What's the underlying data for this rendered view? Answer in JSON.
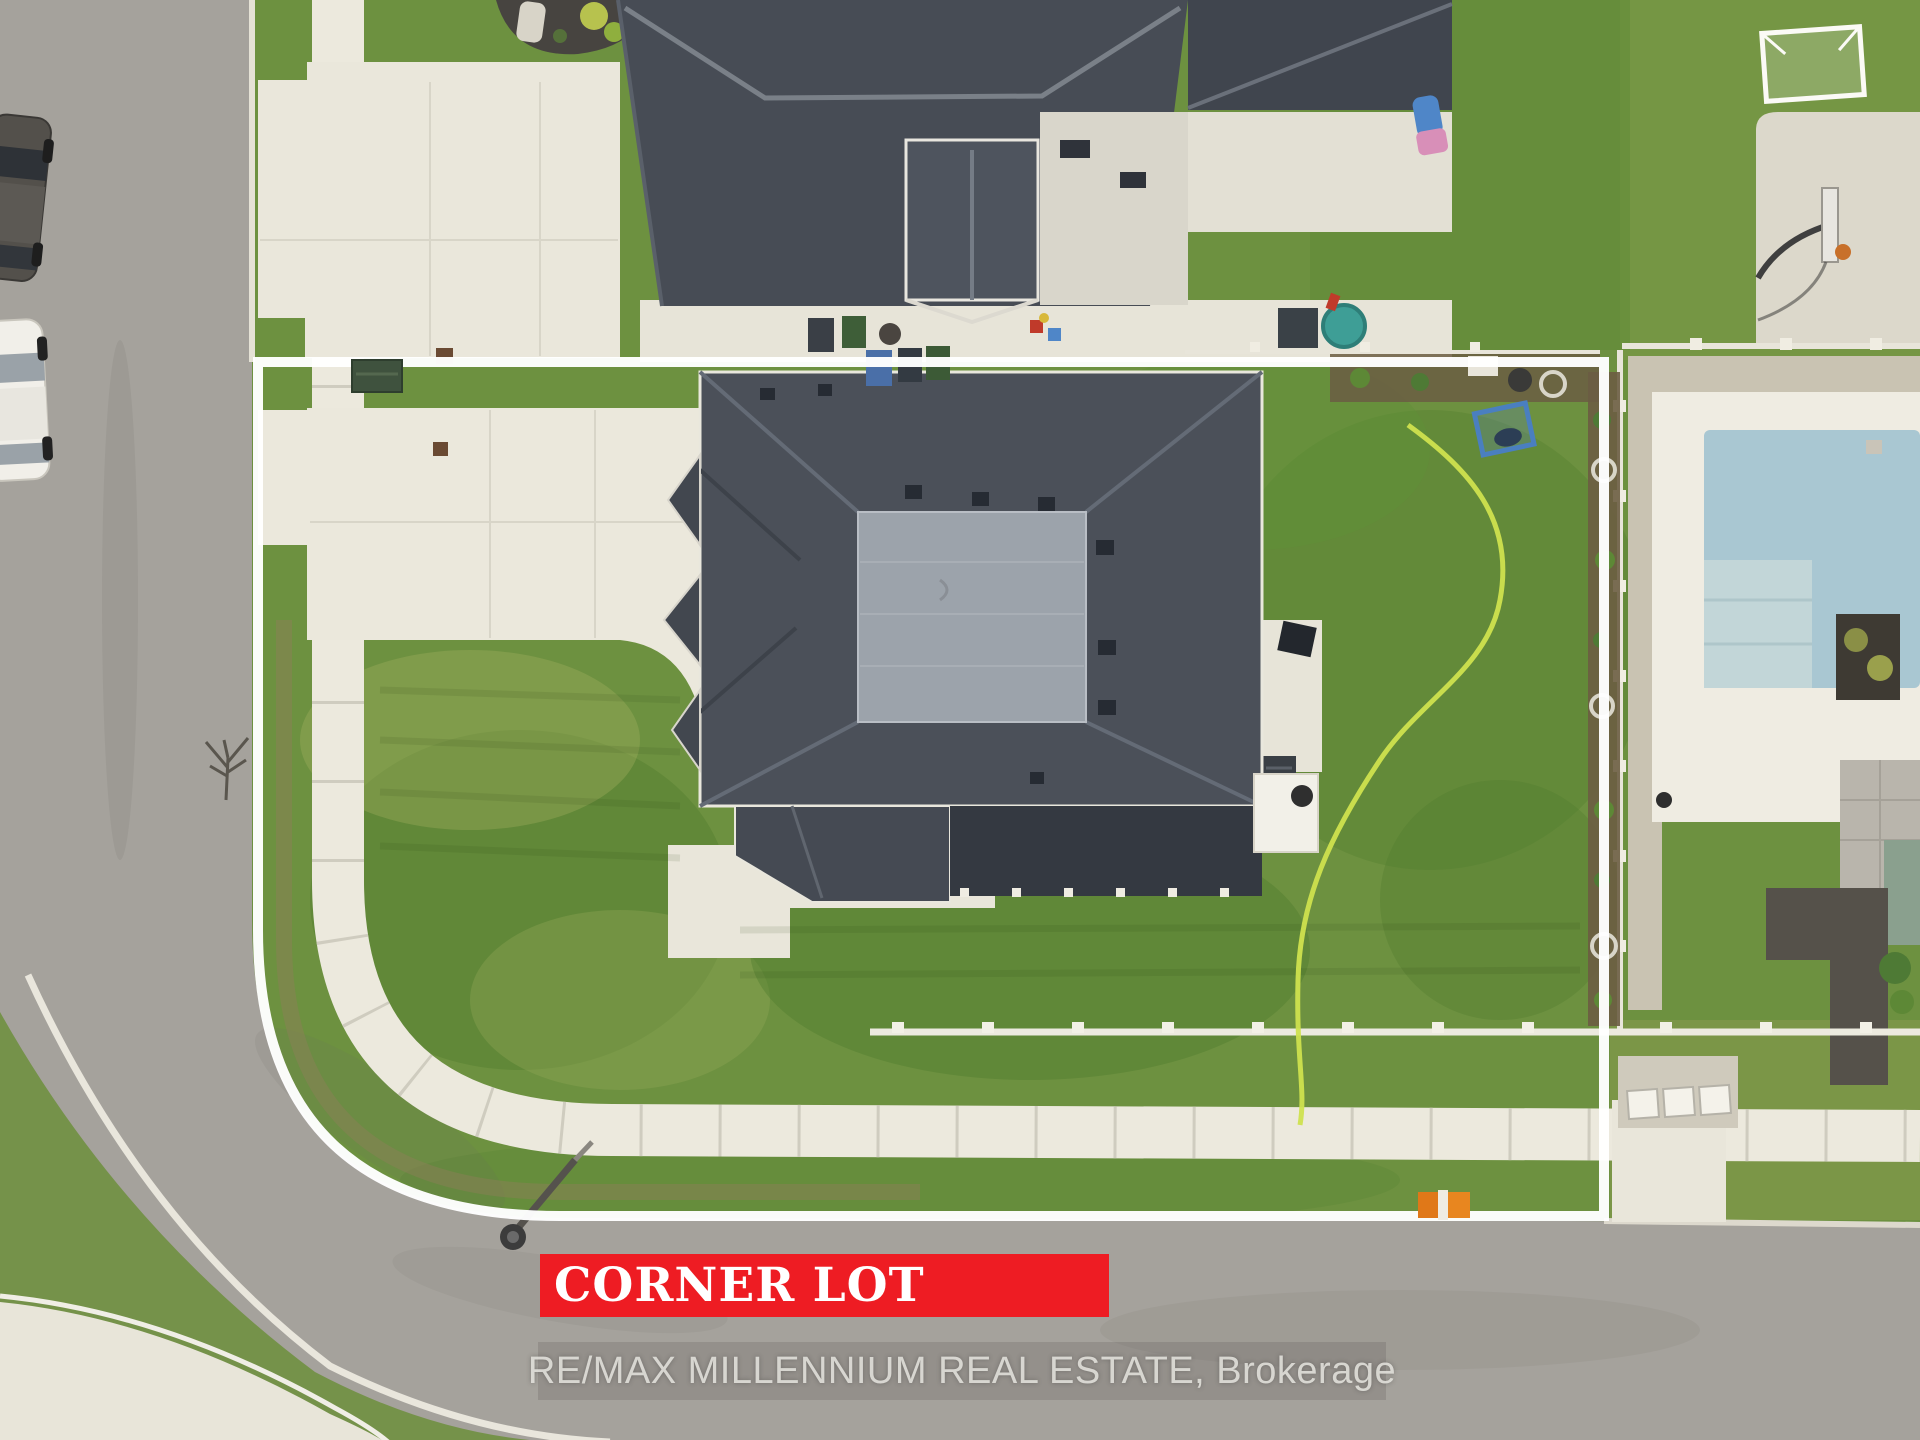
{
  "photo": {
    "type": "aerial-drone-top-down",
    "subject": "residential corner lot with detached house outlined in white",
    "visible_objects": [
      "subject house with dark shingle hip roof and flat roof section",
      "large concrete driveway and curved public sidewalk",
      "front lawn and fenced backyard with garden hose",
      "white property boundary overlay along two street frontages",
      "curved asphalt street corner",
      "two parked cars on left street",
      "street light and orange fire hydrant",
      "neighbour house at top with gable dormer, patio and bins",
      "neighbour yard at right with soccer goal and basketball hoop",
      "neighbour in-ground pool with white deck",
      "bottom-right neighbour driveway and AC units"
    ]
  },
  "banner": {
    "label": "CORNER LOT",
    "bg_color": "#ee1c23",
    "text_color": "#ffffff"
  },
  "watermark": {
    "text": "RE/MAX MILLENNIUM REAL ESTATE, Brokerage",
    "color": "#e4e2dd"
  },
  "boundary_overlay": {
    "color": "#ffffff",
    "shape": "lot outline following curb around street corner"
  }
}
